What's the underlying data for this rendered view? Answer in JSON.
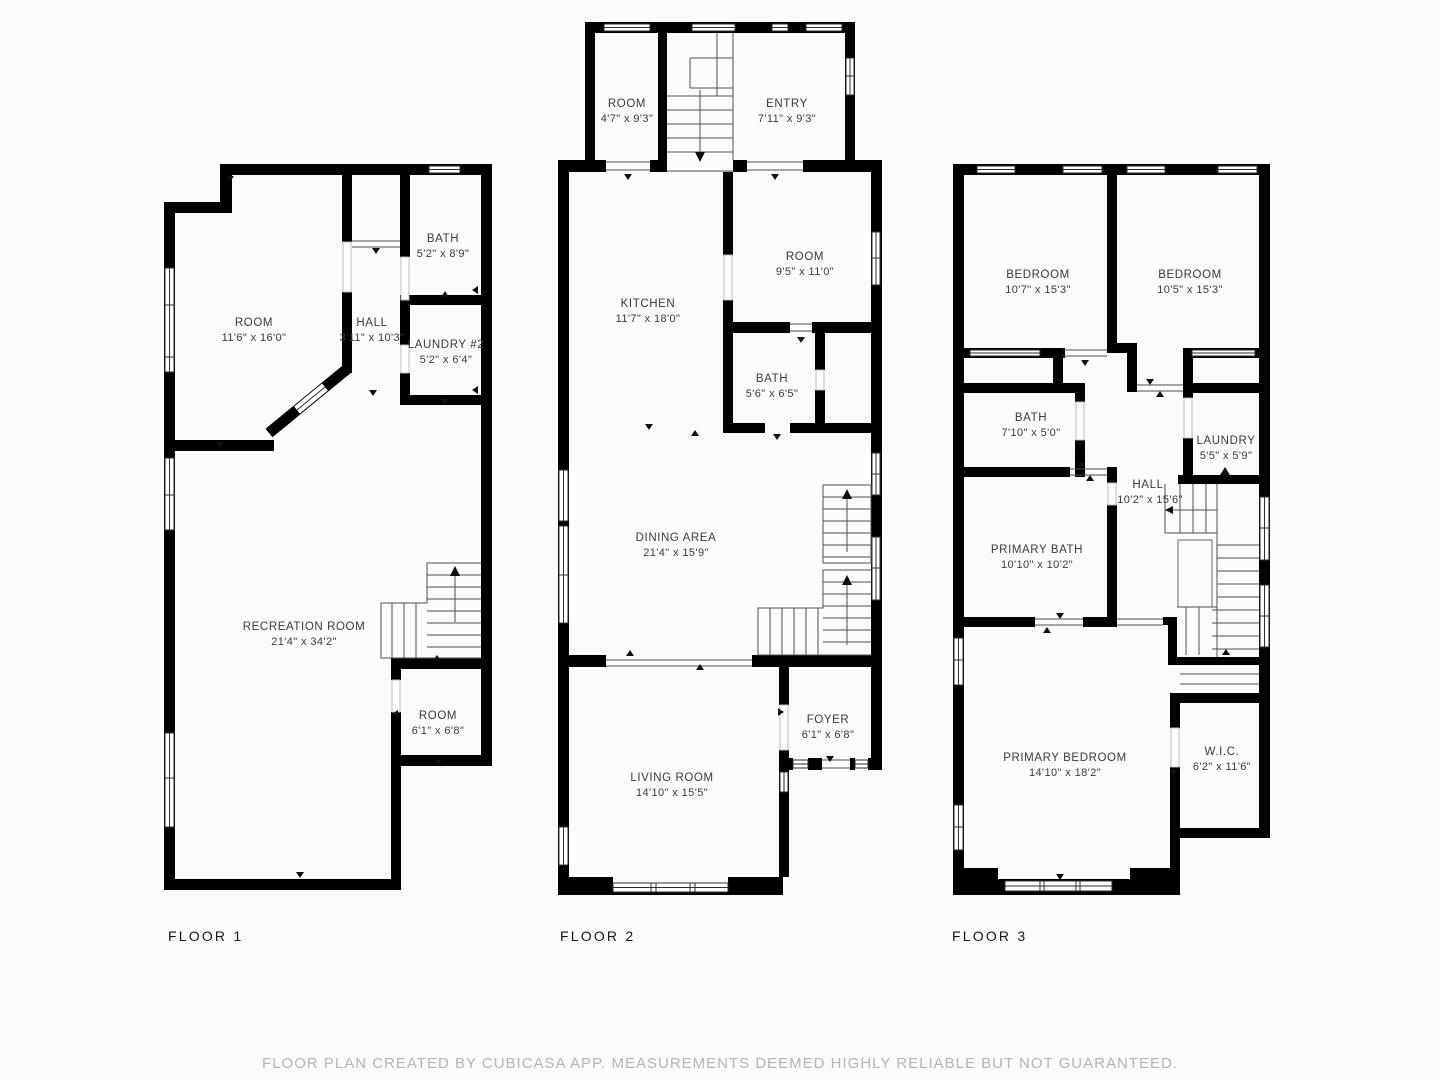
{
  "app": "floor-plan-viewer",
  "colors": {
    "wall": "#000000",
    "label_text": "#3a3a3a",
    "floor_label": "#161616",
    "disclaimer": "#b5b5b5"
  },
  "floors": [
    {
      "label": "FLOOR 1",
      "rooms": [
        {
          "name": "ROOM",
          "dims": "11'6\" x 16'0\""
        },
        {
          "name": "HALL",
          "dims": "3'11\" x 10'3\""
        },
        {
          "name": "BATH",
          "dims": "5'2\" x 8'9\""
        },
        {
          "name": "LAUNDRY #2",
          "dims": "5'2\" x 6'4\""
        },
        {
          "name": "RECREATION ROOM",
          "dims": "21'4\" x 34'2\""
        },
        {
          "name": "ROOM",
          "dims": "6'1\" x 6'8\""
        }
      ]
    },
    {
      "label": "FLOOR 2",
      "rooms": [
        {
          "name": "ROOM",
          "dims": "4'7\" x 9'3\""
        },
        {
          "name": "ENTRY",
          "dims": "7'11\" x 9'3\""
        },
        {
          "name": "KITCHEN",
          "dims": "11'7\" x 18'0\""
        },
        {
          "name": "ROOM",
          "dims": "9'5\" x 11'0\""
        },
        {
          "name": "BATH",
          "dims": "5'6\" x 6'5\""
        },
        {
          "name": "DINING AREA",
          "dims": "21'4\" x 15'9\""
        },
        {
          "name": "FOYER",
          "dims": "6'1\" x 6'8\""
        },
        {
          "name": "LIVING ROOM",
          "dims": "14'10\" x 15'5\""
        }
      ]
    },
    {
      "label": "FLOOR 3",
      "rooms": [
        {
          "name": "BEDROOM",
          "dims": "10'7\" x 15'3\""
        },
        {
          "name": "BEDROOM",
          "dims": "10'5\" x 15'3\""
        },
        {
          "name": "BATH",
          "dims": "7'10\" x 5'0\""
        },
        {
          "name": "LAUNDRY",
          "dims": "5'5\" x 5'9\""
        },
        {
          "name": "HALL",
          "dims": "10'2\" x 15'6\""
        },
        {
          "name": "PRIMARY BATH",
          "dims": "10'10\" x 10'2\""
        },
        {
          "name": "PRIMARY BEDROOM",
          "dims": "14'10\" x 18'2\""
        },
        {
          "name": "W.I.C.",
          "dims": "6'2\" x 11'6\""
        }
      ]
    }
  ],
  "disclaimer": "FLOOR PLAN CREATED BY CUBICASA APP. MEASUREMENTS DEEMED HIGHLY RELIABLE BUT NOT GUARANTEED."
}
